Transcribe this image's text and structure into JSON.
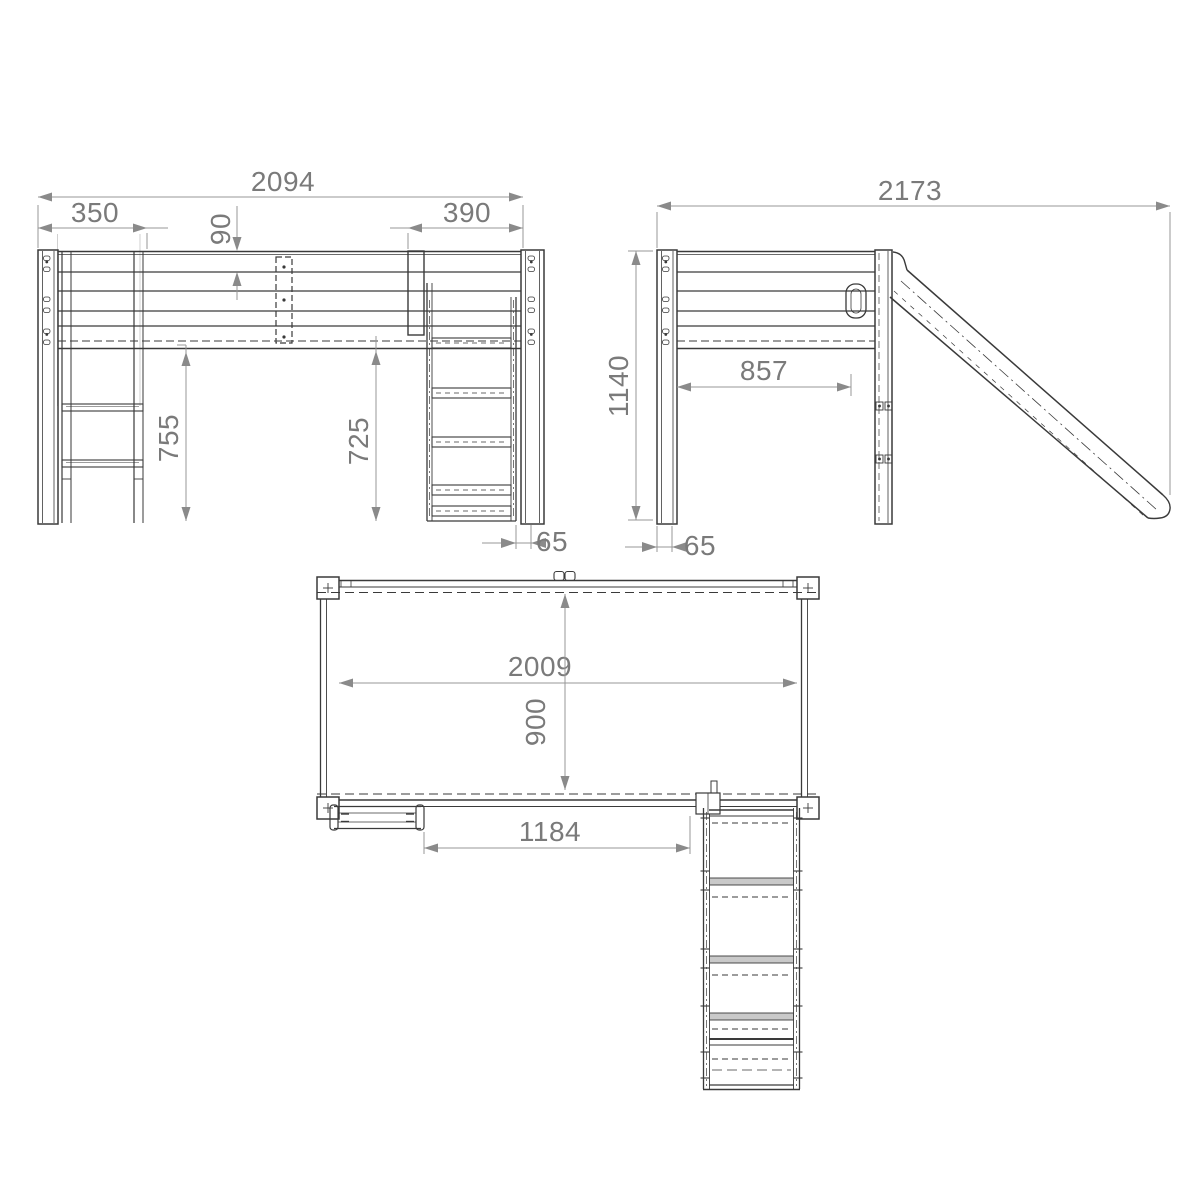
{
  "drawing": {
    "background": "#ffffff",
    "line_color": "#3a3a3a",
    "dim_line_color": "#979797",
    "text_color": "#7a7a7a",
    "front_view": {
      "overall_width": "2094",
      "ladder_span": "350",
      "guardrail_height": "90",
      "slide_span": "390",
      "clearance_left": "755",
      "clearance_right": "725",
      "edge_offset": "65"
    },
    "side_view": {
      "overall_depth": "2173",
      "total_height": "1140",
      "inner_span": "857",
      "leg_width": "65"
    },
    "top_view": {
      "bed_length": "2009",
      "bed_width": "900",
      "ladder_to_slide": "1184"
    }
  }
}
